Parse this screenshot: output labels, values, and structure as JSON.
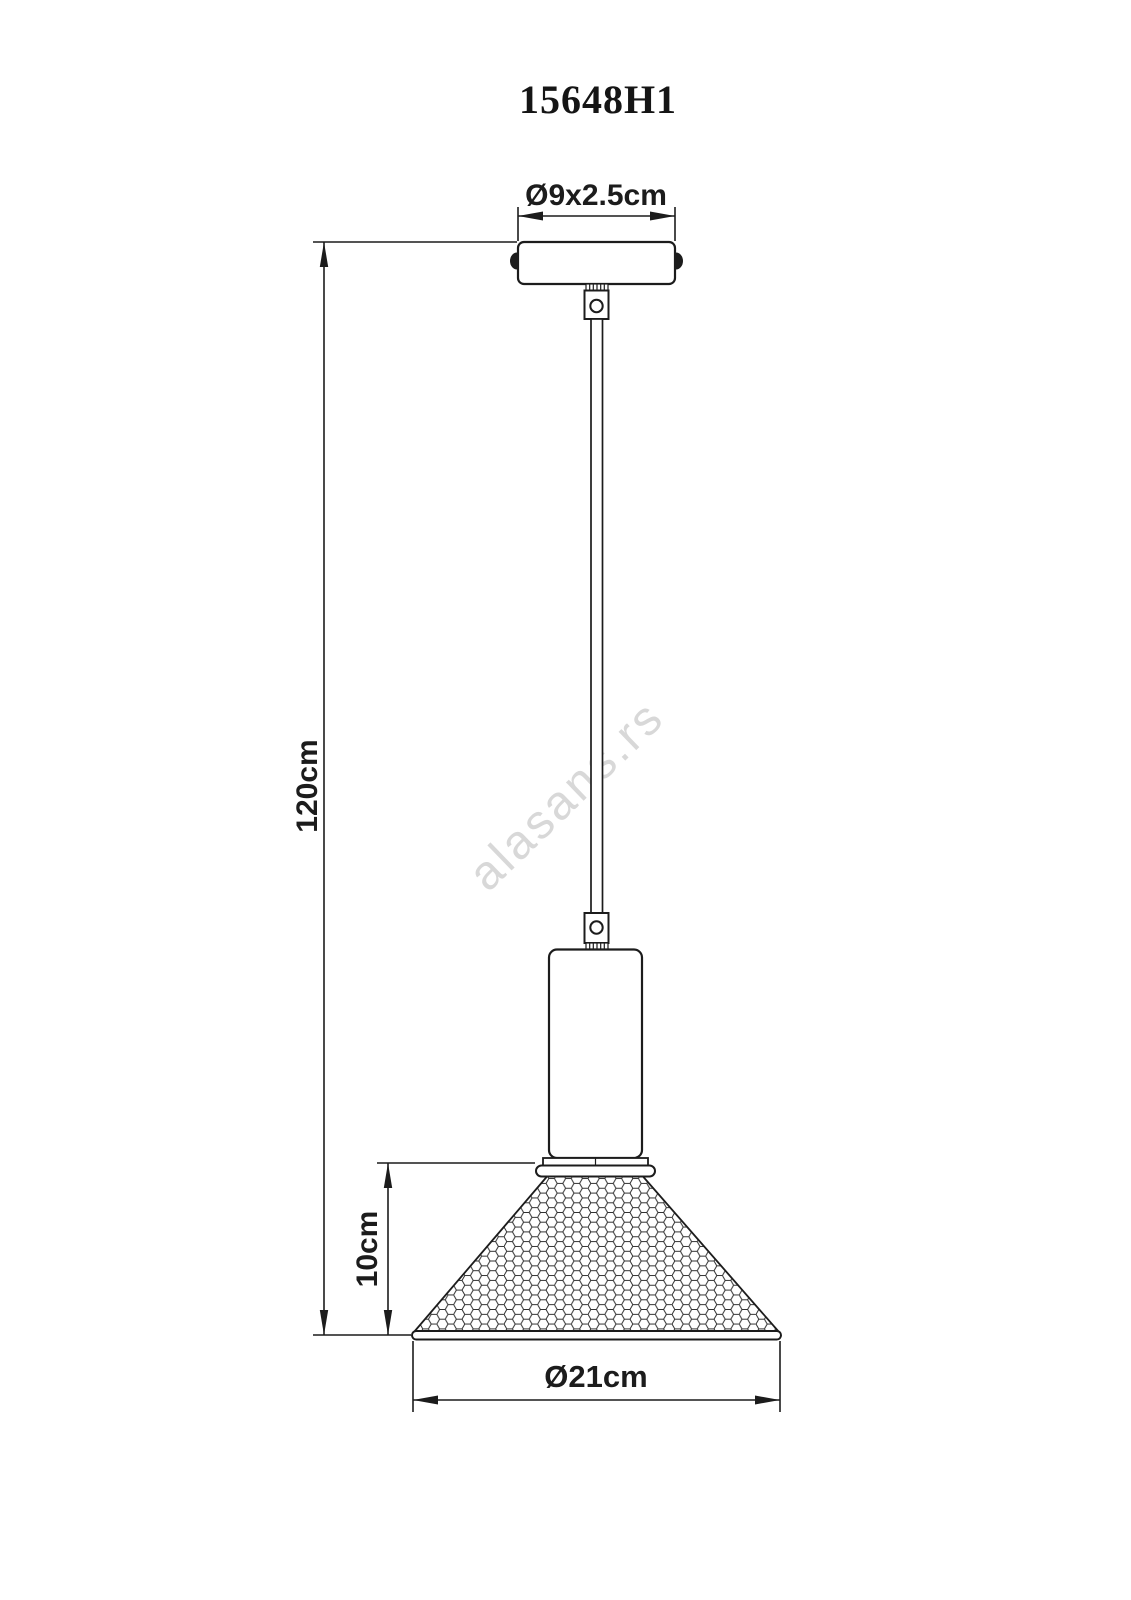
{
  "drawing": {
    "title": "15648H1",
    "watermark": "alasans.rs",
    "dimensions": {
      "canopy": "Ø9x2.5cm",
      "overall_height": "120cm",
      "shade_height": "10cm",
      "shade_diameter": "Ø21cm"
    },
    "colors": {
      "line": "#1c1c1c",
      "watermark": "#d8d8d8",
      "background": "#ffffff"
    }
  }
}
